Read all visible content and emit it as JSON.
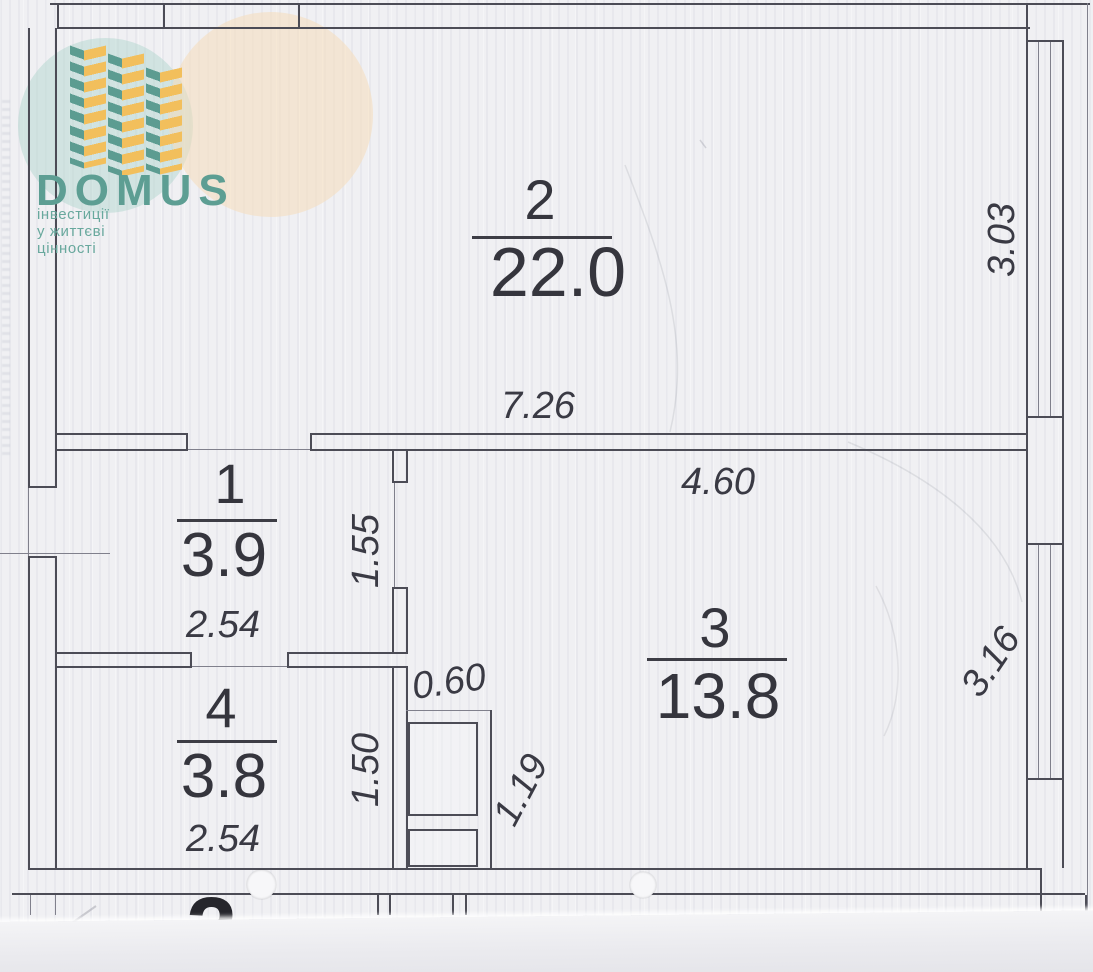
{
  "logo": {
    "brand": "DOMUS",
    "tagline": "інвестиції у життєві цінності",
    "brand_color": "#5d9e93",
    "accent_teal": "#5c9c91",
    "accent_yellow": "#f2bf5c"
  },
  "rooms": [
    {
      "number": "1",
      "area": "3.9"
    },
    {
      "number": "2",
      "area": "22.0"
    },
    {
      "number": "3",
      "area": "13.8"
    },
    {
      "number": "4",
      "area": "3.8"
    }
  ],
  "dims": {
    "room2_width": "7.26",
    "room2_height": "3.03",
    "room3_width": "4.60",
    "room3_height": "3.16",
    "room1_width": "2.54",
    "room1_height": "1.55",
    "room4_width": "2.54",
    "room4_height": "1.50",
    "shaft_width": "0.60",
    "shaft_height": "1.19"
  },
  "floor_label_partial": "2"
}
